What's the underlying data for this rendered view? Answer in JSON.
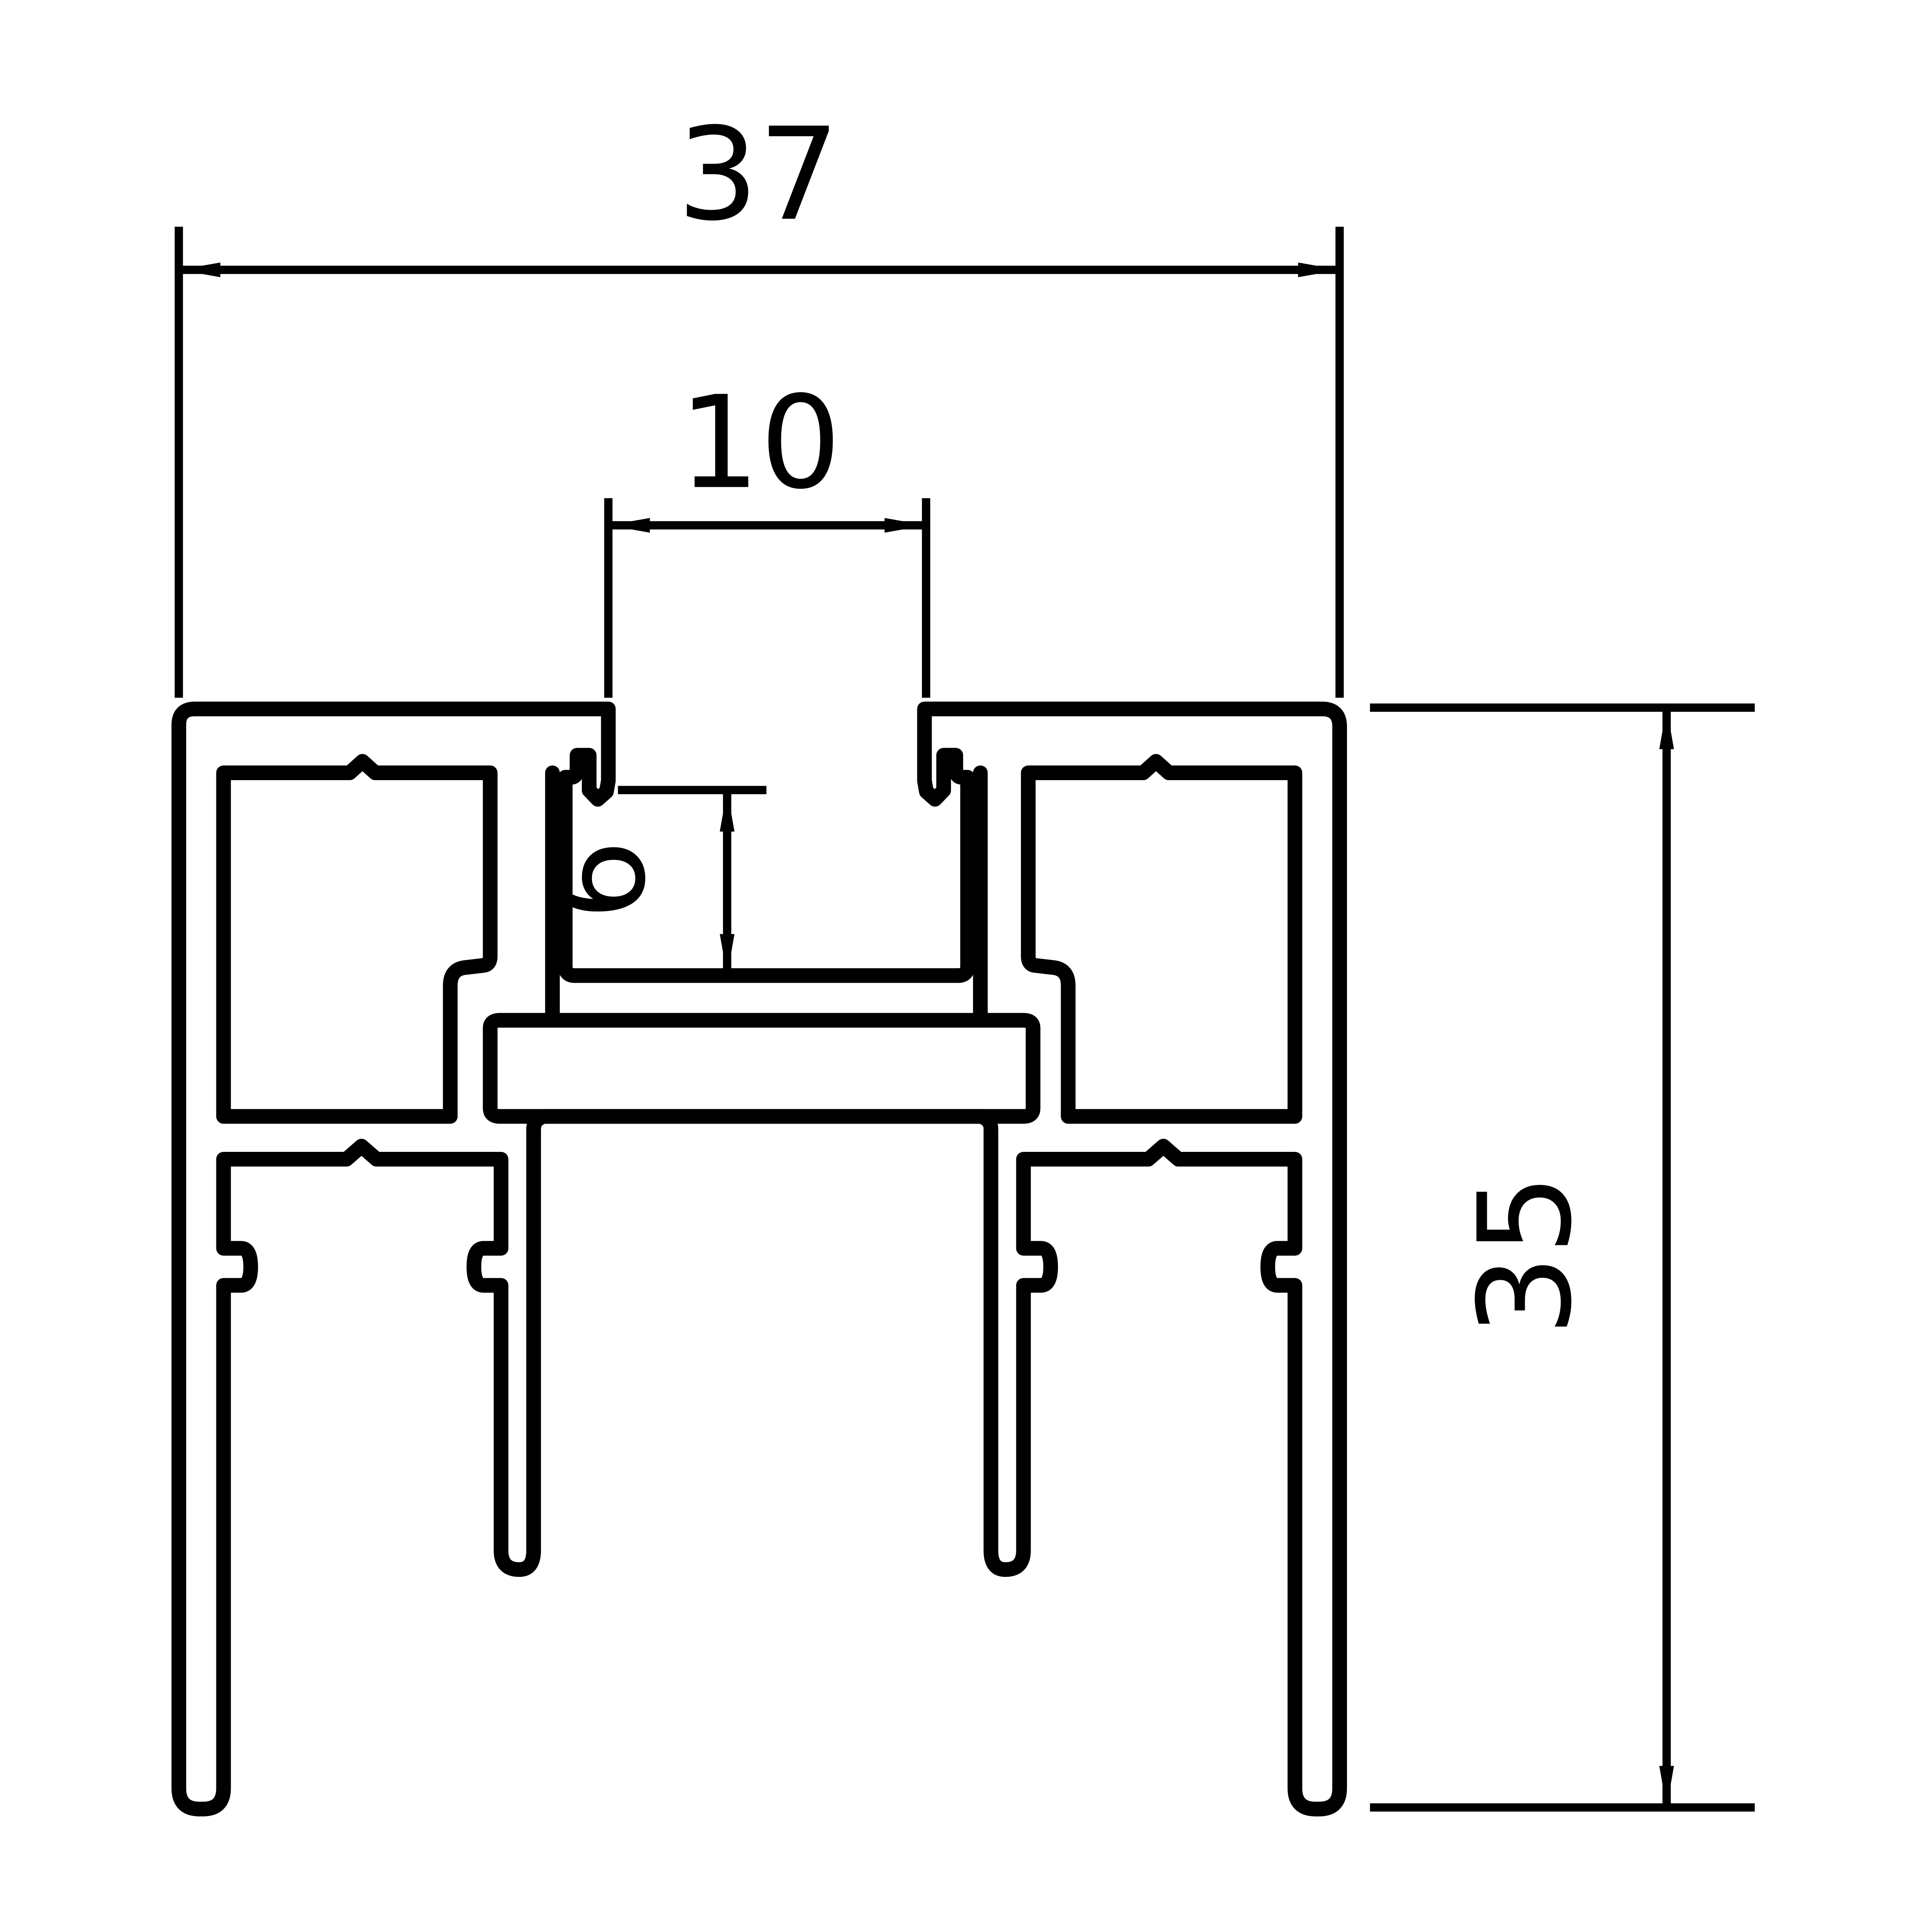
{
  "drawing": {
    "type": "technical-profile-cross-section",
    "background_color": "#ffffff",
    "line_color": "#000000",
    "dimensions": {
      "overall_width": "37",
      "slot_width": "10",
      "groove_depth": "6",
      "overall_height": "35"
    }
  }
}
